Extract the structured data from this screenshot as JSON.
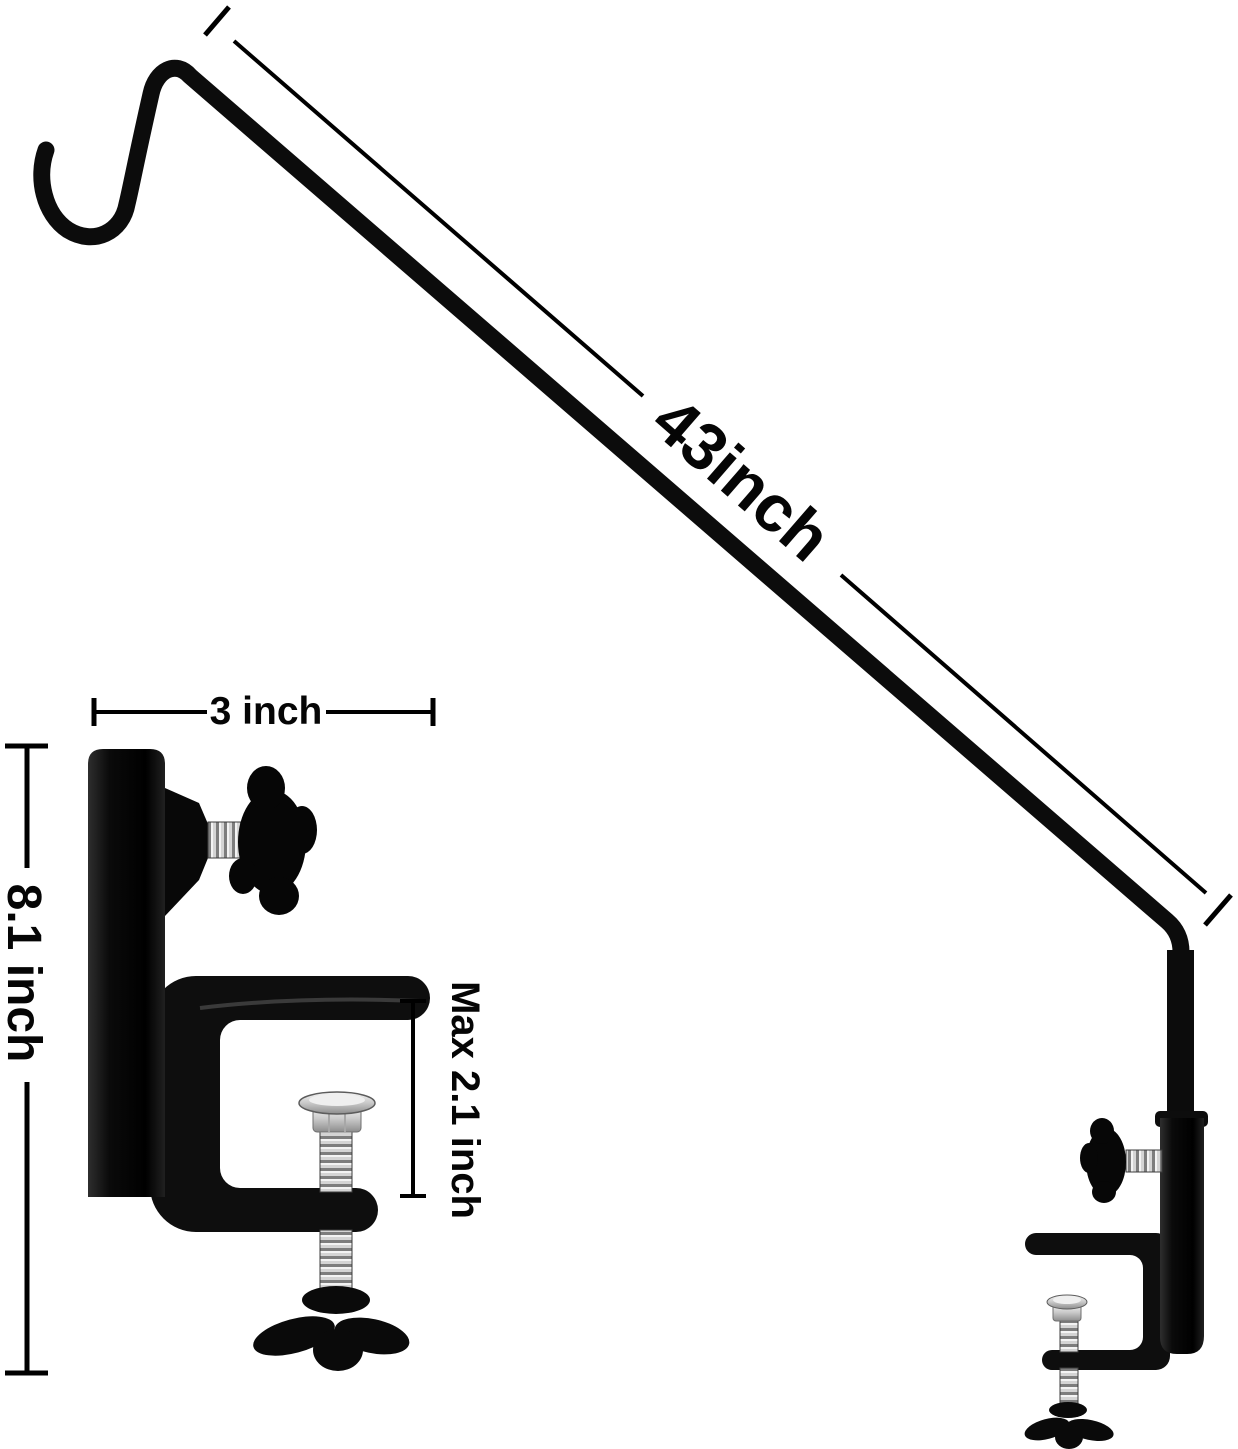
{
  "labels": {
    "pole_length": "43inch",
    "mount_width": "3 inch",
    "mount_height": "8.1 inch",
    "clamp_max_opening": "Max 2.1 inch"
  },
  "colors": {
    "background": "#ffffff",
    "metal_black": "#0c0c0c",
    "thread_silver": "#c9c9c9",
    "dimension_line": "#000000"
  }
}
